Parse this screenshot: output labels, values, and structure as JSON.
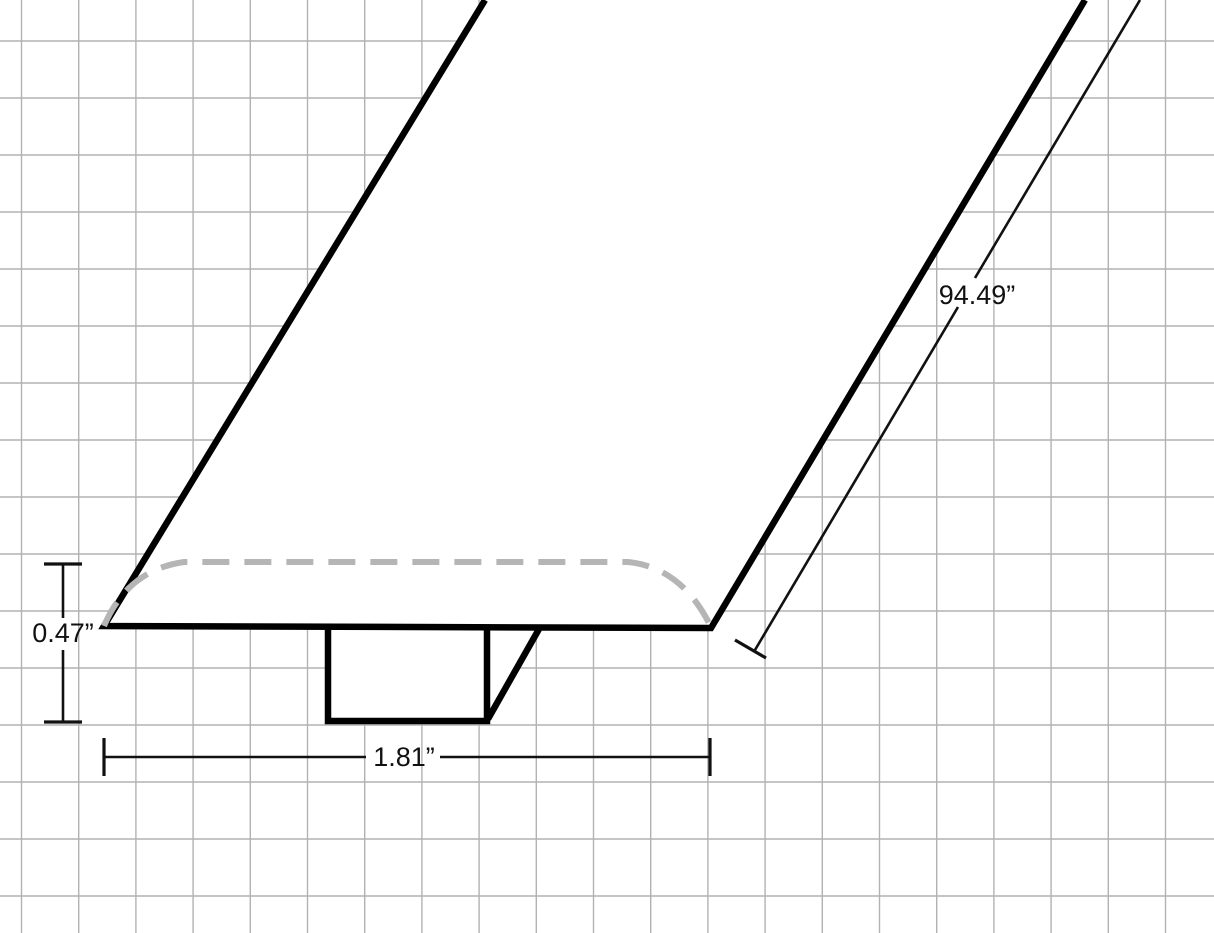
{
  "diagram": {
    "labels": {
      "thickness": "0.47”",
      "width": "1.81”",
      "length": "94.49”"
    },
    "colors": {
      "outline": "#000000",
      "hidden_edge": "#b5b5b5",
      "grid_line": "#b2b2b2",
      "dimension_line": "#111111",
      "text": "#111111",
      "background": "#ffffff"
    }
  }
}
